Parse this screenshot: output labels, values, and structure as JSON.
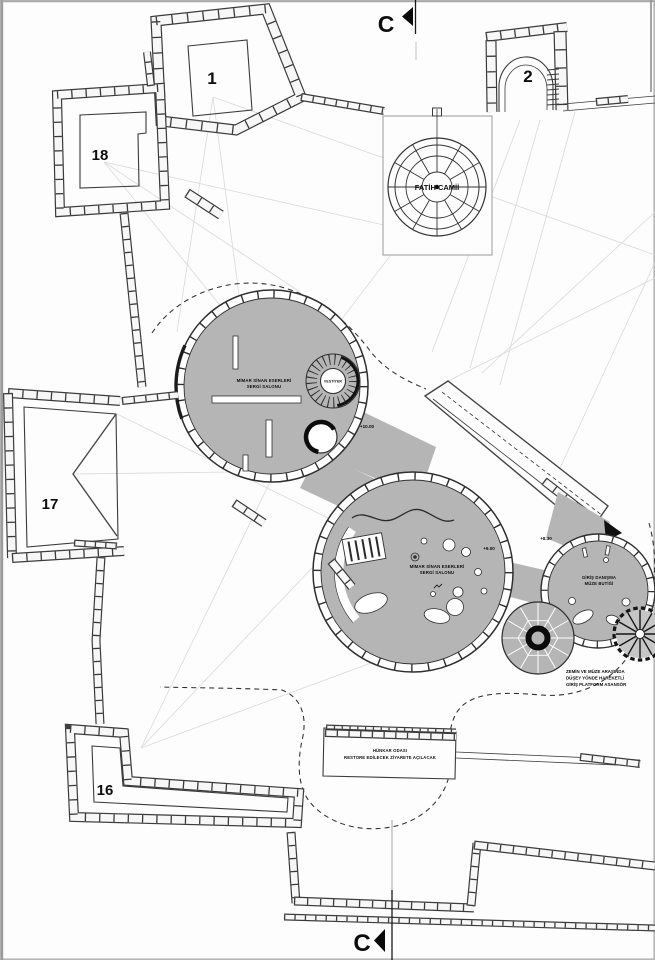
{
  "plan": {
    "section_marker_top": "C",
    "section_marker_bottom": "C",
    "mosque_label": "FATİH CAMİİ",
    "rooms": {
      "tower_ne": "1",
      "gate_e": "2",
      "tower_sw": "16",
      "tower_w": "17",
      "tower_nw": "18"
    },
    "hall_upper": {
      "line1": "MİMAR SİNAN ESERLERİ",
      "line2": "SERGİ SALONU",
      "elevation": "+10.00"
    },
    "hall_lower": {
      "line1": "MİMAR SİNAN ESERLERİ",
      "line2": "SERGİ SALONU",
      "elevation": "+9.00"
    },
    "vestiyer_label": "VESTİYER",
    "entrance": {
      "line1": "GİRİŞ DANIŞMA",
      "line2": "MÜZE BUTİĞİ",
      "elevation": "+8.30"
    },
    "hunkar": {
      "line1": "HÜNKAR ODASI",
      "line2": "RESTORE EDİLECEK ZİYARETE AÇILACAK"
    },
    "elevator_note": {
      "line1": "ZEMİN VE MÜZE ARASINDA",
      "line2": "DÜŞEY YÖNDE HAREKETLİ",
      "line3": "GİRİŞ PLATFORM ASANSÖR"
    },
    "colors": {
      "site_gray": "#b5b5b5",
      "line_dark": "#2f2f2f",
      "sight_line": "#d9d9d9",
      "background": "#fdfdfd"
    }
  }
}
